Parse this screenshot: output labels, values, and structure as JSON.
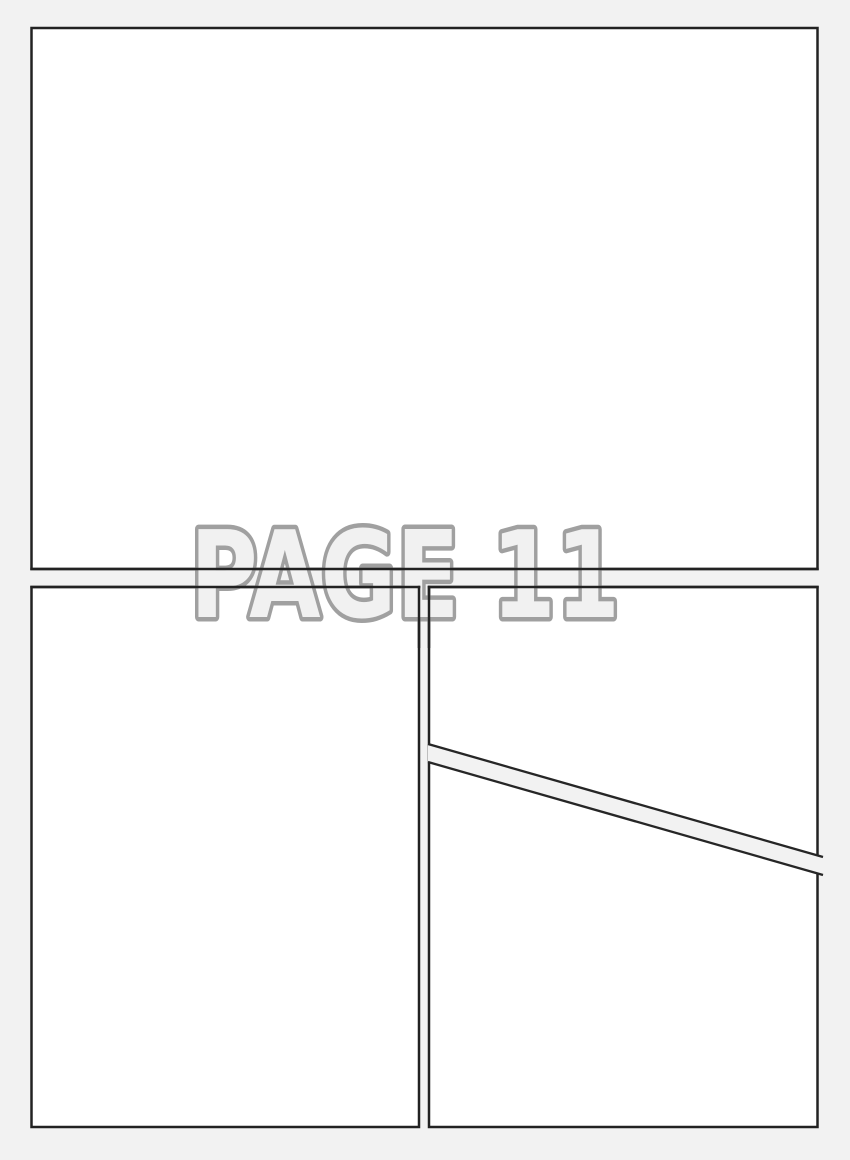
{
  "page": {
    "label": "PAGE 11"
  },
  "colors": {
    "background": "#f2f2f2",
    "panel_fill": "#ffffff",
    "panel_border": "#222222",
    "label_fill": "#f1f1f1",
    "label_outline": "#a0a0a0"
  },
  "panels": [
    {
      "name": "top-panel"
    },
    {
      "name": "bottom-left-panel"
    },
    {
      "name": "bottom-right-upper-panel"
    },
    {
      "name": "bottom-right-lower-panel"
    }
  ]
}
